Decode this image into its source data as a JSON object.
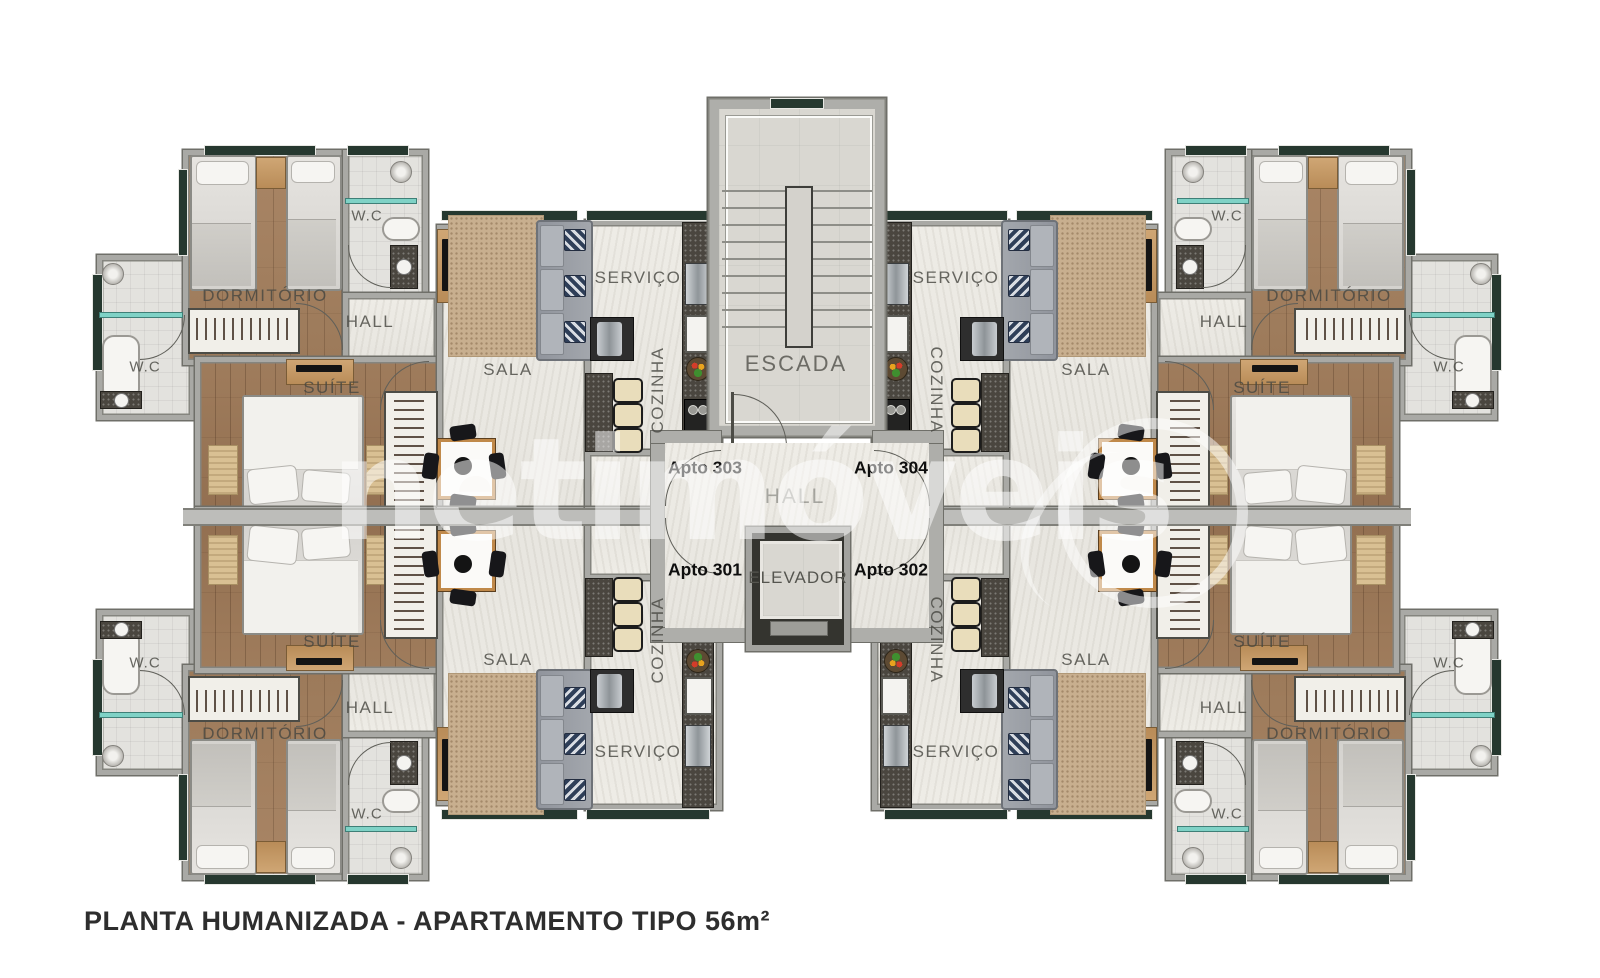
{
  "title": "PLANTA HUMANIZADA - APARTAMENTO TIPO 56m²",
  "watermark": {
    "text": "netimóveis"
  },
  "core": {
    "stairs_label": "ESCADA",
    "hall_label": "HALL",
    "elevator_label": "ELEVADOR"
  },
  "apartments": [
    {
      "label": "Apto 303",
      "position": "top-left",
      "rooms": {
        "dormitorio": "DORMITÓRIO",
        "wc_social": "W.C",
        "hall": "HALL",
        "sala": "SALA",
        "servico": "SERVIÇO",
        "cozinha": "COZINHA",
        "suite": "SUÍTE",
        "wc_suite": "W.C"
      }
    },
    {
      "label": "Apto 304",
      "position": "top-right",
      "rooms": {
        "dormitorio": "DORMITÓRIO",
        "wc_social": "W.C",
        "hall": "HALL",
        "sala": "SALA",
        "servico": "SERVIÇO",
        "cozinha": "COZINHA",
        "suite": "SUÍTE",
        "wc_suite": "W.C"
      }
    },
    {
      "label": "Apto 301",
      "position": "bottom-left",
      "rooms": {
        "dormitorio": "DORMITÓRIO",
        "wc_social": "W.C",
        "hall": "HALL",
        "sala": "SALA",
        "servico": "SERVIÇO",
        "cozinha": "COZINHA",
        "suite": "SUÍTE",
        "wc_suite": "W.C"
      }
    },
    {
      "label": "Apto 302",
      "position": "bottom-right",
      "rooms": {
        "dormitorio": "DORMITÓRIO",
        "wc_social": "W.C",
        "hall": "HALL",
        "sala": "SALA",
        "servico": "SERVIÇO",
        "cozinha": "COZINHA",
        "suite": "SUÍTE",
        "wc_suite": "W.C"
      }
    }
  ]
}
